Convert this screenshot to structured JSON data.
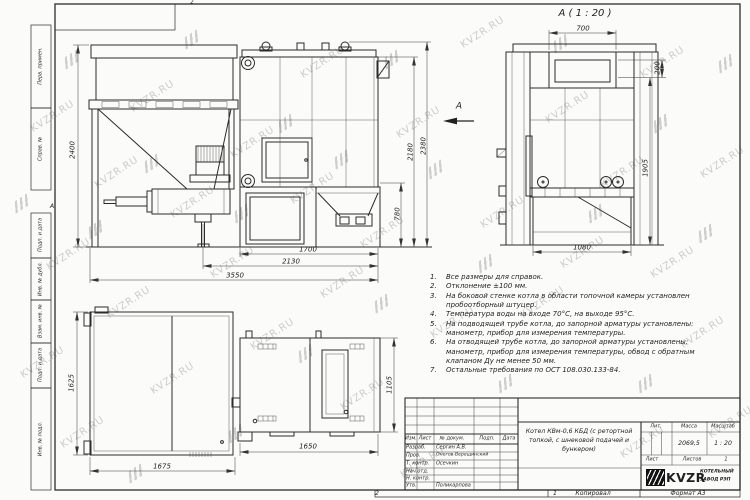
{
  "sheet": {
    "zone_top": "2",
    "zone_bottom": "2",
    "zone_left": "А",
    "copy_row": {
      "sheet_no": "1",
      "copied": "Копировал",
      "format": "Формат А3"
    }
  },
  "watermark": {
    "text": "KVZR.RU",
    "spots": [
      [
        28,
        112
      ],
      [
        92,
        168
      ],
      [
        44,
        250
      ],
      [
        18,
        358
      ],
      [
        58,
        428
      ],
      [
        128,
        92
      ],
      [
        104,
        298
      ],
      [
        168,
        198
      ],
      [
        148,
        374
      ],
      [
        228,
        138
      ],
      [
        208,
        258
      ],
      [
        248,
        330
      ],
      [
        298,
        58
      ],
      [
        288,
        184
      ],
      [
        318,
        278
      ],
      [
        358,
        228
      ],
      [
        338,
        390
      ],
      [
        394,
        118
      ],
      [
        428,
        318
      ],
      [
        458,
        28
      ],
      [
        478,
        208
      ],
      [
        518,
        298
      ],
      [
        543,
        103
      ],
      [
        558,
        248
      ],
      [
        598,
        168
      ],
      [
        638,
        58
      ],
      [
        648,
        258
      ],
      [
        678,
        328
      ],
      [
        698,
        158
      ],
      [
        706,
        418
      ],
      [
        618,
        438
      ],
      [
        398,
        458
      ]
    ],
    "glyph_spots": [
      [
        64,
        54
      ],
      [
        14,
        198
      ],
      [
        184,
        34
      ],
      [
        144,
        158
      ],
      [
        88,
        224
      ],
      [
        234,
        208
      ],
      [
        278,
        118
      ],
      [
        334,
        154
      ],
      [
        384,
        54
      ],
      [
        428,
        164
      ],
      [
        374,
        298
      ],
      [
        298,
        348
      ],
      [
        478,
        258
      ],
      [
        553,
        38
      ],
      [
        588,
        208
      ],
      [
        653,
        118
      ],
      [
        698,
        228
      ],
      [
        638,
        378
      ],
      [
        498,
        378
      ],
      [
        228,
        428
      ],
      [
        128,
        468
      ],
      [
        718,
        58
      ]
    ]
  },
  "margin_fields": [
    "Перв. примен.",
    "Справ. №",
    "Подп. и дата",
    "Инв. № дубл.",
    "Взам. инв. №",
    "Подп. и дата",
    "Инв. № подл."
  ],
  "views": {
    "section_title": "А ( 1 : 20 )",
    "section_arrow_label": "А"
  },
  "dims": {
    "bunker_height": "2400",
    "boiler_height_overall": "2380",
    "boiler_height_body": "2180",
    "ash_section_height": "780",
    "furnace_length": "1700",
    "feeder_length": "2130",
    "overall_length": "3550",
    "sec_top_width": "700",
    "sec_collar_height": "200",
    "sec_body_height": "1905",
    "sec_base_width": "1080",
    "bunker_depth": "1625",
    "bunker_width": "1675",
    "boiler_width": "1650",
    "boiler_depth": "1105"
  },
  "notes": {
    "lines": [
      {
        "n": "1.",
        "t": "Все размеры для справок."
      },
      {
        "n": "2.",
        "t": "Отклонение ±100 мм."
      },
      {
        "n": "3.",
        "t": "На боковой стенке котла в области топочной камеры установлен"
      },
      {
        "n": "",
        "t": "пробоотборный штуцер."
      },
      {
        "n": "4.",
        "t": "Температура воды на входе 70°С, на выходе 95°С."
      },
      {
        "n": "5.",
        "t": "На подводящей трубе котла, до запорной арматуры установлены:"
      },
      {
        "n": "",
        "t": "манометр, прибор для измерения температуры."
      },
      {
        "n": "6.",
        "t": "На отводящей трубе котла, до запорной арматуры установлены:"
      },
      {
        "n": "",
        "t": "манометр, прибор для измерения температуры, обвод с обратным"
      },
      {
        "n": "",
        "t": "клапаном Ду не менее 50 мм."
      },
      {
        "n": "7.",
        "t": "Остальные требования по ОСТ 108.030.133-84."
      }
    ]
  },
  "title_block": {
    "header": {
      "izm": "Изм.",
      "list": "Лист",
      "doc": "№ докум.",
      "podp": "Подп.",
      "data": "Дата"
    },
    "rows": [
      {
        "role": "Разраб.",
        "name": "Сергин А.В."
      },
      {
        "role": "Пров.",
        "name": "Онегов-Верещинский"
      },
      {
        "role": "Т. контр.",
        "name": "Осечкин"
      },
      {
        "role": "Нач.отд.",
        "name": ""
      },
      {
        "role": "Н. контр.",
        "name": ""
      },
      {
        "role": "Утв.",
        "name": "Поликарпова"
      }
    ],
    "doc_title_lines": [
      "Котел КВм-0,6 КБД (с ретортной",
      "топкой, с шнековой подачей и",
      "бункером)"
    ],
    "lit_label": "Лит.",
    "mass_label": "Масса",
    "scale_label": "Масштаб",
    "mass_value": "2069,5",
    "scale_value": "1 : 20",
    "sheet_label": "Лист",
    "sheets_label": "Листов",
    "sheets_value": "1",
    "company": {
      "logo_text": "KVZR",
      "line1": "КОТЕЛЬНЫЙ",
      "line2": "ЗАВОД РЭП"
    }
  }
}
